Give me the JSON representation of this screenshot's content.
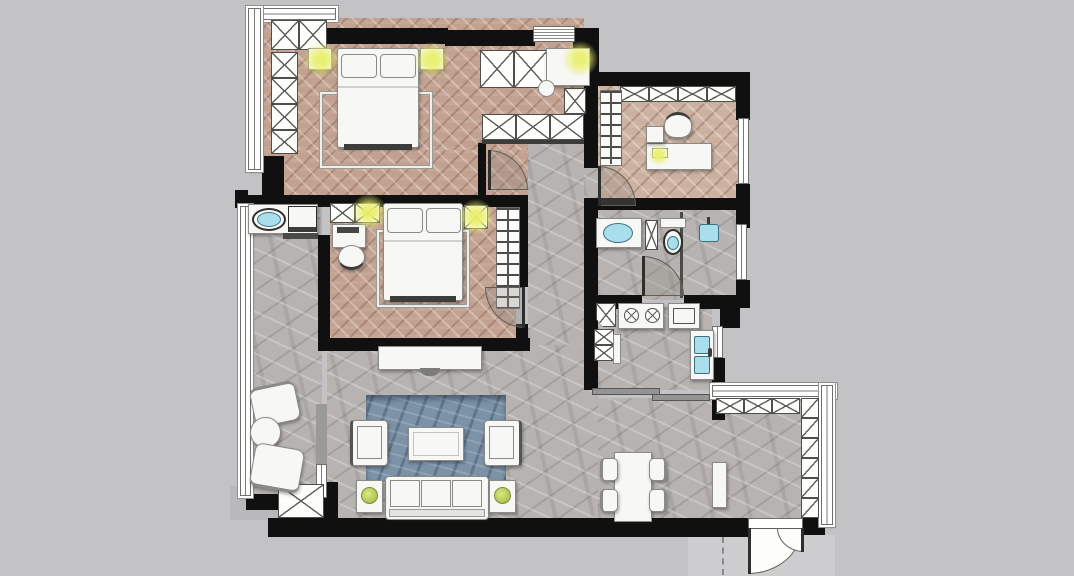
{
  "meta": {
    "type": "residential-floor-plan",
    "view": "top-down",
    "visible_text": "none"
  },
  "palette": {
    "background": "#c3c3c6",
    "wall": "#101010",
    "wood_floor": "#c2a190",
    "wood_floor_light": "#ccb1a0",
    "stone_floor": "#b6b3b0",
    "rug_blue": "#7b92a7",
    "furniture_white": "#f7f7f5",
    "lamp_glow": "#eaf06e",
    "water_fixture": "#a9dfec",
    "plant_green": "#b9cc5e"
  },
  "rooms": [
    {
      "id": "master-bedroom",
      "floor": "herringbone-wood",
      "contents": [
        "double-bed",
        "two-pillows",
        "foot-bench",
        "area-rug",
        "left-nightstand-with-lamp",
        "right-nightstand-with-lamp",
        "wardrobe-x-cabinets",
        "bay-window"
      ]
    },
    {
      "id": "walk-in-closet",
      "floor": "herringbone-wood",
      "contents": [
        "wardrobe-x-cabinets",
        "dressing-table-with-lamp",
        "stool",
        "top-window",
        "swing-door"
      ]
    },
    {
      "id": "study",
      "floor": "herringbone-wood",
      "contents": [
        "l-shaped-desk",
        "desk-chair",
        "desk-lamp",
        "coat-hanger-rack",
        "overhead-x-cabinet-row",
        "right-window",
        "swing-door"
      ]
    },
    {
      "id": "second-bedroom",
      "floor": "herringbone-wood",
      "contents": [
        "double-bed",
        "two-pillows",
        "foot-bench",
        "area-rug",
        "desk-with-monitor",
        "desk-chair",
        "overhead-x-cabinet-with-lamp",
        "nightstand-with-lamp",
        "open-hanger-wardrobe",
        "swing-door"
      ]
    },
    {
      "id": "bathroom",
      "floor": "stone-tile",
      "contents": [
        "vanity-counter-with-sink",
        "narrow-x-cabinet",
        "toilet",
        "glass-partition",
        "shower-head",
        "right-window",
        "swing-door"
      ]
    },
    {
      "id": "kitchen",
      "floor": "stone-tile",
      "contents": [
        "corner-cabinet",
        "gas-stove-two-burners",
        "oven-appliance",
        "base-x-cabinets",
        "double-basin-sink",
        "right-window",
        "sliding-door"
      ]
    },
    {
      "id": "living-room",
      "floor": "stone-tile",
      "contents": [
        "tv-console",
        "blue-area-rug",
        "coffee-table",
        "left-armchair",
        "right-armchair",
        "three-seat-sofa",
        "two-side-tables-with-plants"
      ]
    },
    {
      "id": "dining-hall",
      "floor": "stone-tile",
      "contents": [
        "dining-table",
        "four-chairs",
        "console-cabinet",
        "leaning-panel"
      ]
    },
    {
      "id": "entry",
      "floor": "stone-tile",
      "contents": [
        "shoe-x-cabinet-row",
        "tall-slash-cabinet-column",
        "double-entrance-door",
        "perimeter-windows",
        "swing-dash-line"
      ]
    },
    {
      "id": "balcony-laundry",
      "floor": "stone-tile",
      "contents": [
        "laundry-counter-with-sink",
        "washing-machine",
        "shelf",
        "two-lounge-chairs",
        "round-side-table",
        "x-storage-cabinet",
        "left-window-band"
      ]
    }
  ]
}
